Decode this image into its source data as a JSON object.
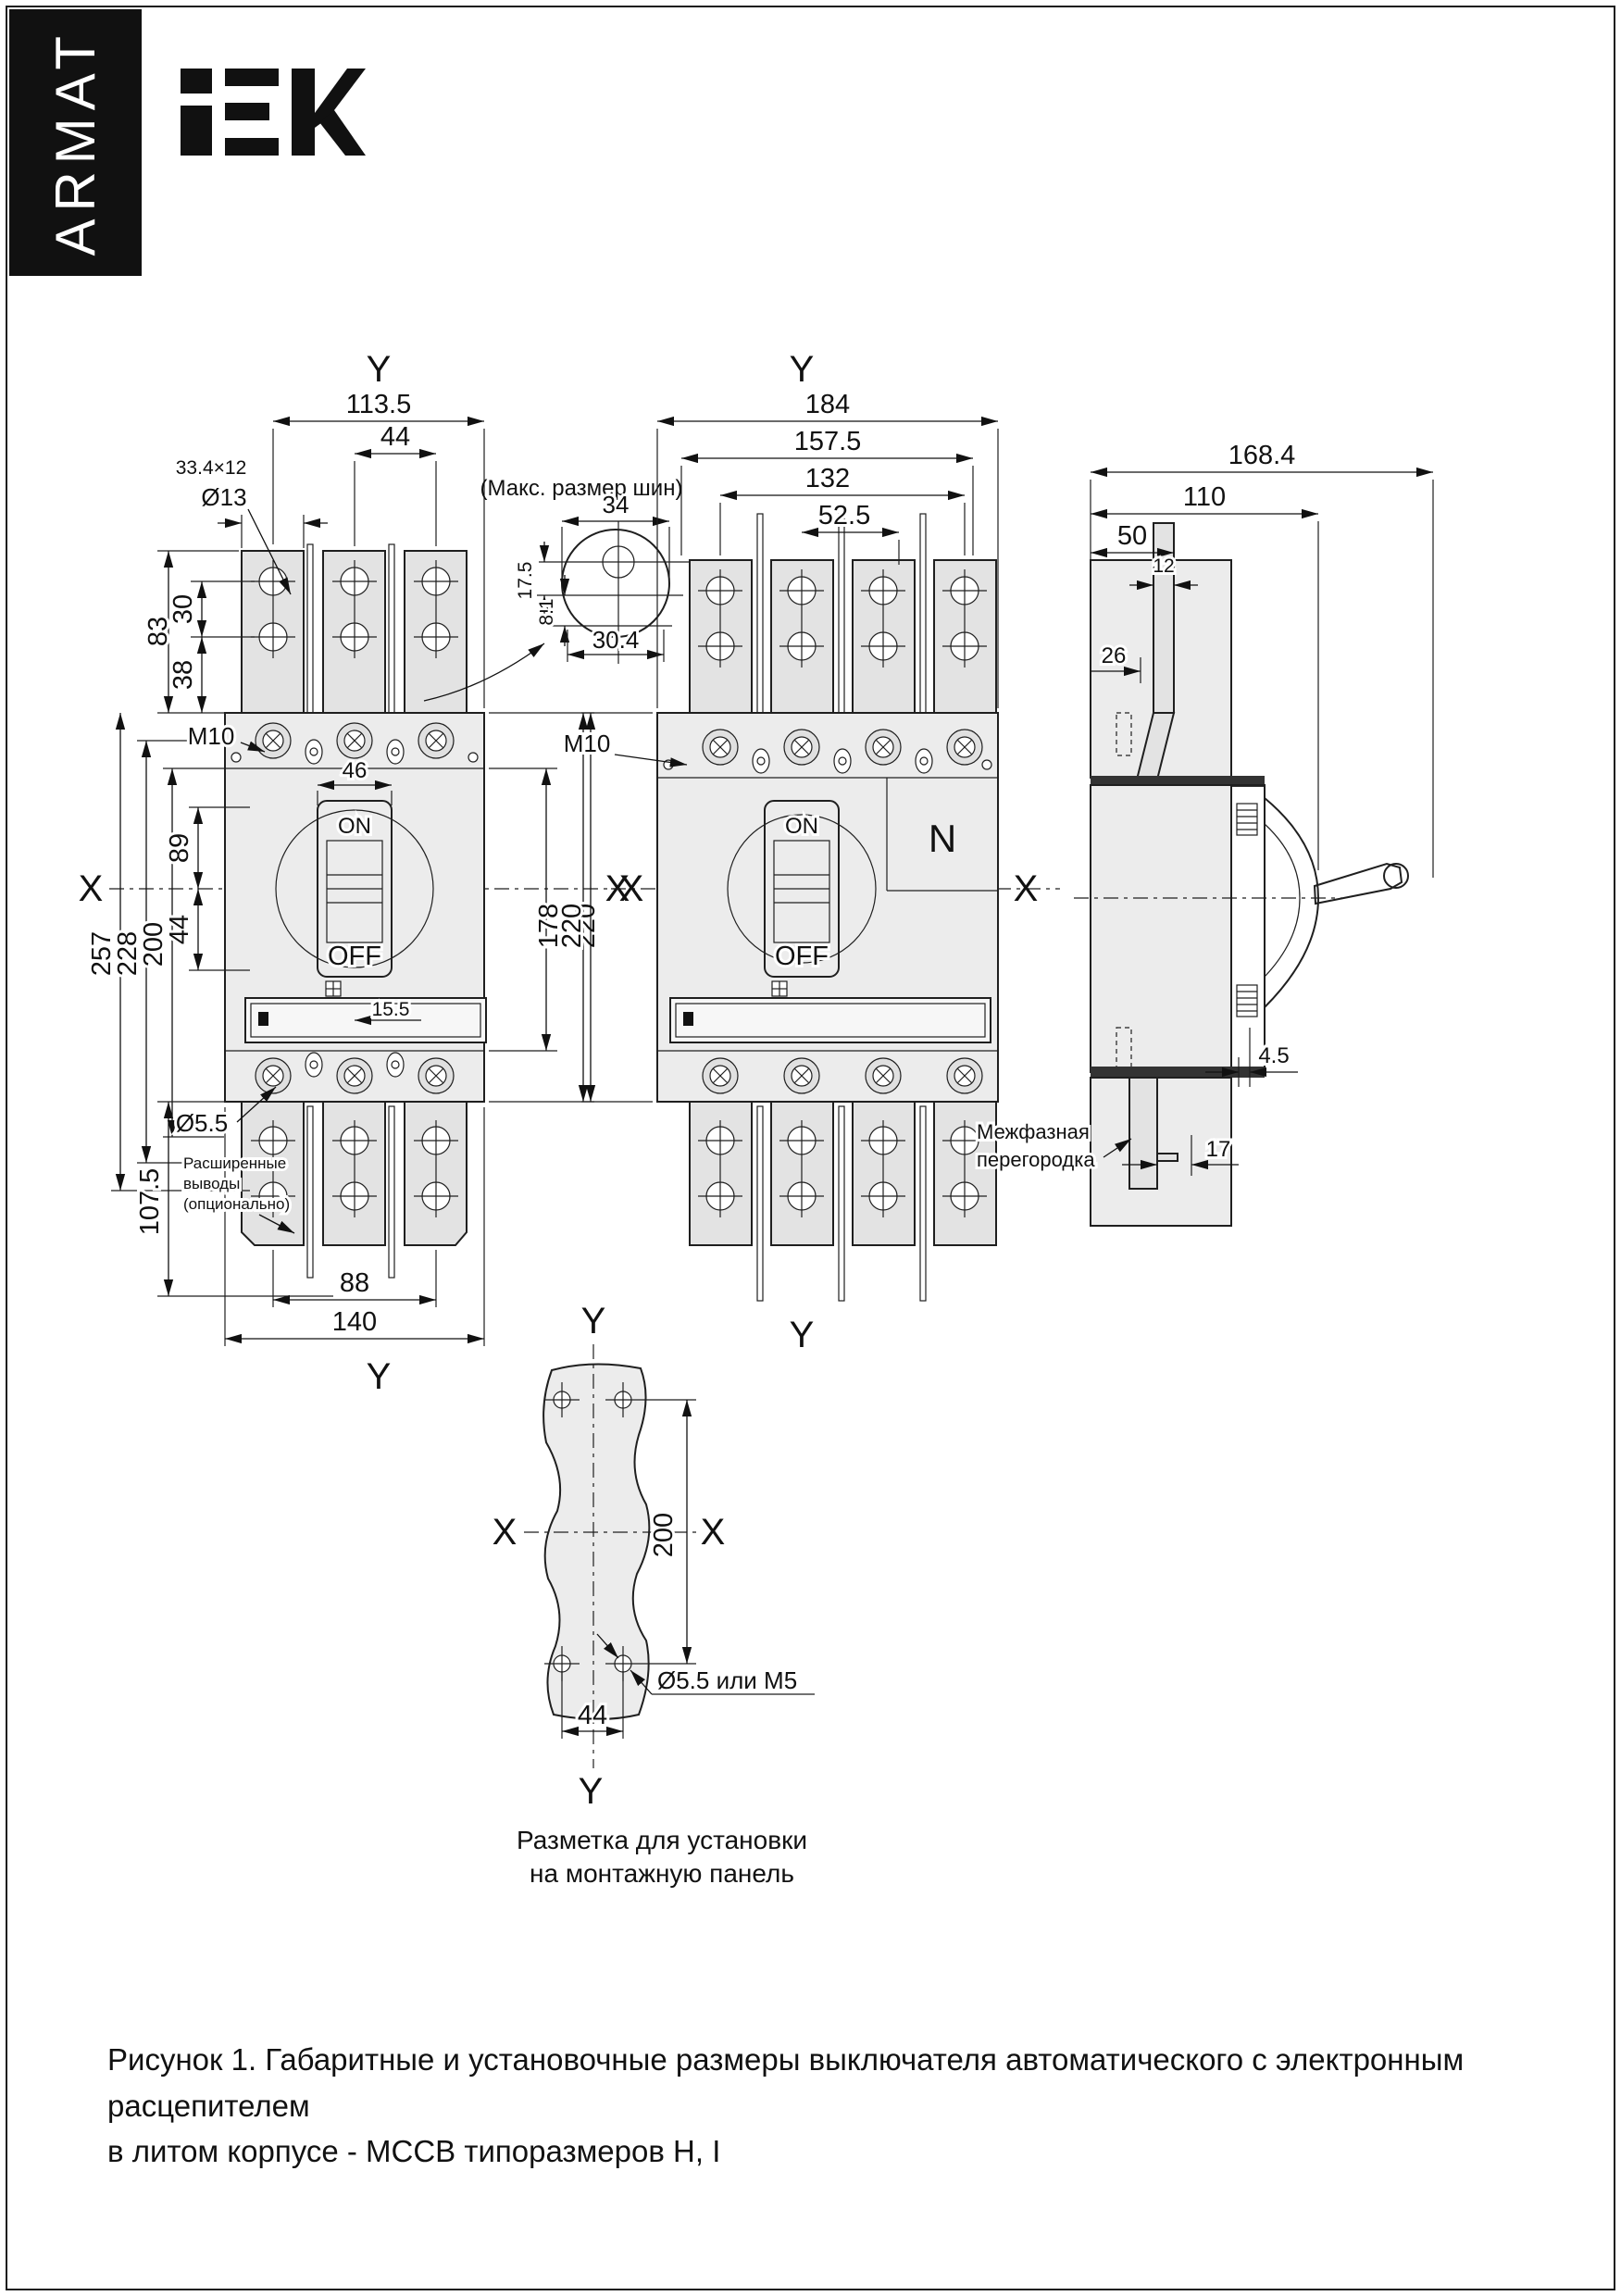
{
  "page": {
    "brand": "ARMAT",
    "logo": "IEK",
    "figure_caption_line1": "Рисунок 1. Габаритные и установочные размеры выключателя автоматического с электронным расцепителем",
    "figure_caption_line2": "в литом корпусе - MCCB типоразмеров H, I"
  },
  "front_view": {
    "axis_top": "Y",
    "axis_bottom": "Y",
    "axis_left": "X",
    "axis_right": "X",
    "dim_width_overall": "113.5",
    "dim_pole_pitch": "44",
    "dim_lug_section": "33.4×12",
    "dim_hole_top": "Ø13",
    "dim_h83": "83",
    "dim_h30": "30",
    "dim_h38": "38",
    "thread_label": "M10",
    "dim_h257": "257",
    "dim_h228": "228",
    "dim_h200": "200",
    "dim_h89": "89",
    "dim_h44": "44",
    "dim_w46": "46",
    "dim_h178": "178",
    "dim_h220": "220",
    "dim_w15_5": "15.5",
    "dim_hole_bottom": "Ø5.5",
    "dim_h107_5": "107.5",
    "dim_w88": "88",
    "dim_w140": "140",
    "switch_on": "ON",
    "switch_off": "OFF",
    "note_line1": "Расширенные",
    "note_line2": "выводы",
    "note_line3": "(опционально)"
  },
  "busbar_detail": {
    "title": "(Макс. размер шин)",
    "dim_w34": "34",
    "dim_h17_5": "17.5",
    "dim_h8_1": "8.1",
    "dim_w30_4": "30.4"
  },
  "four_pole_view": {
    "axis_top": "Y",
    "axis_bottom": "Y",
    "axis_left": "X",
    "axis_right": "X",
    "dim_w184": "184",
    "dim_w157_5": "157.5",
    "dim_w132": "132",
    "dim_w52_5": "52.5",
    "thread_label": "M10",
    "dim_h220": "220",
    "switch_on": "ON",
    "switch_off": "OFF",
    "neutral_label": "N"
  },
  "side_view": {
    "dim_w168_4": "168.4",
    "dim_w110": "110",
    "dim_w50": "50",
    "dim_w12": "12",
    "dim_w26": "26",
    "dim_h4_5": "4.5",
    "dim_w17": "17",
    "note_line1": "Межфазная",
    "note_line2": "перегородка"
  },
  "panel_layout": {
    "axis_top": "Y",
    "axis_bottom": "Y",
    "axis_left": "X",
    "axis_right": "X",
    "dim_h200": "200",
    "dim_w44": "44",
    "hole_label": "Ø5.5 или M5",
    "caption_line1": "Разметка для установки",
    "caption_line2": "на монтажную панель"
  }
}
